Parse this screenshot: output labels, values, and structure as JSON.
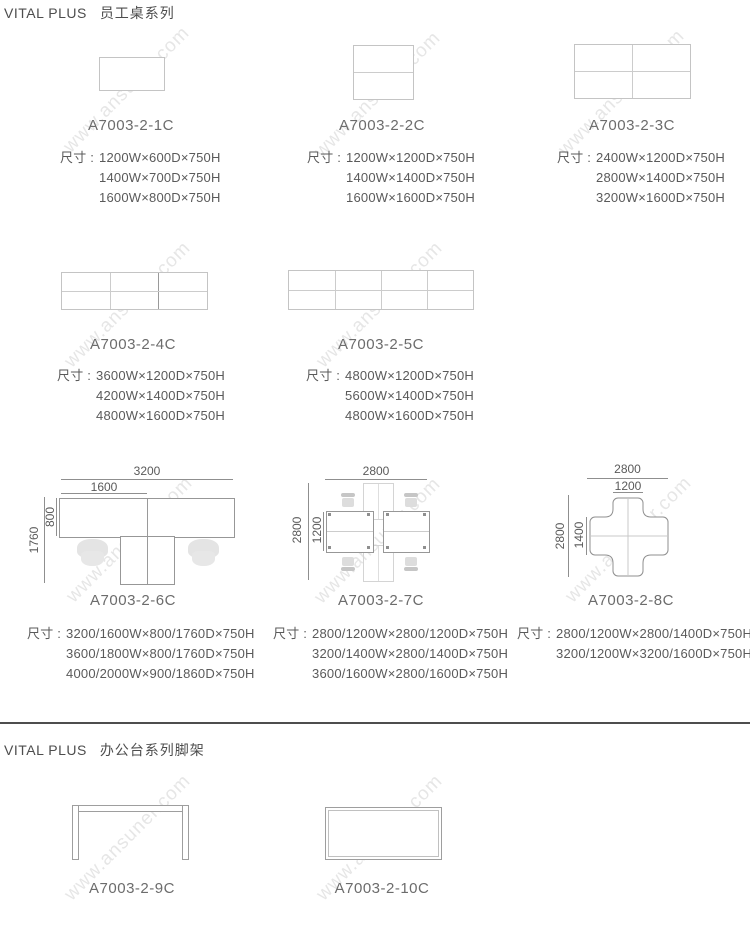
{
  "watermark": {
    "text": "www.ansuner.com"
  },
  "section1": {
    "brand": "VITAL PLUS",
    "title": "员工桌系列",
    "dim_label": "尺寸 :",
    "products": [
      {
        "model": "A7003-2-1C",
        "dims": [
          "1200W×600D×750H",
          "1400W×700D×750H",
          "1600W×800D×750H"
        ]
      },
      {
        "model": "A7003-2-2C",
        "dims": [
          "1200W×1200D×750H",
          "1400W×1400D×750H",
          "1600W×1600D×750H"
        ]
      },
      {
        "model": "A7003-2-3C",
        "dims": [
          "2400W×1200D×750H",
          "2800W×1400D×750H",
          "3200W×1600D×750H"
        ]
      },
      {
        "model": "A7003-2-4C",
        "dims": [
          "3600W×1200D×750H",
          "4200W×1400D×750H",
          "4800W×1600D×750H"
        ]
      },
      {
        "model": "A7003-2-5C",
        "dims": [
          "4800W×1200D×750H",
          "5600W×1400D×750H",
          "4800W×1600D×750H"
        ]
      },
      {
        "model": "A7003-2-6C",
        "dims": [
          "3200/1600W×800/1760D×750H",
          "3600/1800W×800/1760D×750H",
          "4000/2000W×900/1860D×750H"
        ],
        "ann": {
          "top_outer": "3200",
          "top_inner": "1600",
          "side_outer": "1760",
          "side_inner": "800"
        }
      },
      {
        "model": "A7003-2-7C",
        "dims": [
          "2800/1200W×2800/1200D×750H",
          "3200/1400W×2800/1400D×750H",
          "3600/1600W×2800/1600D×750H"
        ],
        "ann": {
          "top_outer": "2800",
          "side_outer": "2800",
          "side_inner": "1200"
        }
      },
      {
        "model": "A7003-2-8C",
        "dims": [
          "2800/1200W×2800/1400D×750H",
          "3200/1200W×3200/1600D×750H"
        ],
        "ann": {
          "top_outer": "2800",
          "top_inner": "1200",
          "side_outer": "2800",
          "side_inner": "1400"
        }
      }
    ]
  },
  "section2": {
    "brand": "VITAL PLUS",
    "title": "办公台系列脚架",
    "products": [
      {
        "model": "A7003-2-9C"
      },
      {
        "model": "A7003-2-10C"
      }
    ]
  }
}
